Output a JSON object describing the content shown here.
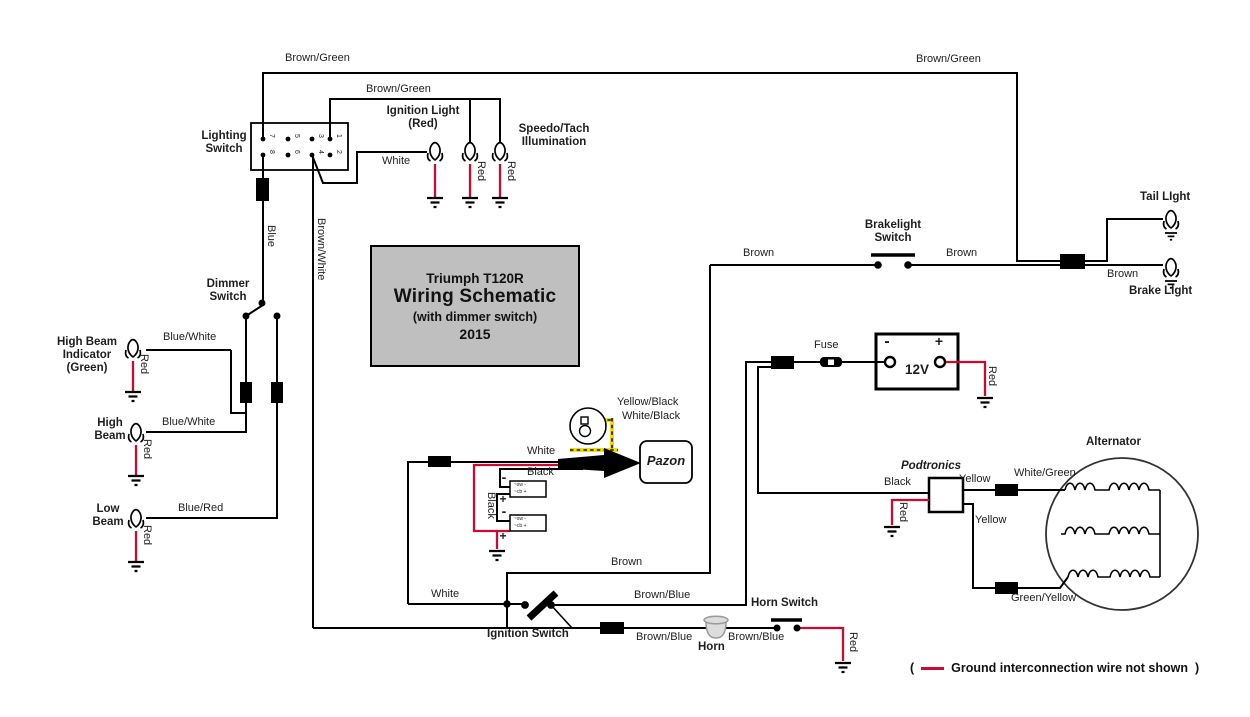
{
  "diagram": {
    "title_block": {
      "line1": "Triumph T120R",
      "line2": "Wiring Schematic",
      "line3": "(with dimmer switch)",
      "line4": "2015"
    },
    "legend": {
      "prefix": "(",
      "note": "Ground interconnection wire not shown",
      "suffix": ")"
    },
    "lighting_switch_pins": {
      "top_row": [
        "7",
        "5",
        "3",
        "1"
      ],
      "bottom_row": [
        "8",
        "6",
        "4",
        "2"
      ]
    },
    "colors": {
      "wire_black": "#000000",
      "ground_red": "#cb0a33",
      "trigger_yellow": "#f2df00",
      "title_box_bg": "#bfbfbf"
    },
    "labels": [
      {
        "name": "lighting-switch-label",
        "text": "Lighting\nSwitch",
        "x": 224,
        "y": 130,
        "s": 11.5,
        "w": "b",
        "a": "c"
      },
      {
        "name": "dimmer-switch-label",
        "text": "Dimmer\nSwitch",
        "x": 228,
        "y": 278,
        "s": 11.5,
        "w": "b",
        "a": "c"
      },
      {
        "name": "high-beam-indicator-label",
        "text": "High Beam\nIndicator\n(Green)",
        "x": 87,
        "y": 336,
        "s": 11.5,
        "w": "b",
        "a": "c"
      },
      {
        "name": "high-beam-label",
        "text": "High\nBeam",
        "x": 110,
        "y": 417,
        "s": 11.5,
        "w": "b",
        "a": "c"
      },
      {
        "name": "low-beam-label",
        "text": "Low\nBeam",
        "x": 108,
        "y": 503,
        "s": 11.5,
        "w": "b",
        "a": "c"
      },
      {
        "name": "ignition-light-label",
        "text": "Ignition Light\n(Red)",
        "x": 423,
        "y": 105,
        "s": 11.5,
        "w": "b",
        "a": "c"
      },
      {
        "name": "speedo-tach-label",
        "text": "Speedo/Tach\nIllumination",
        "x": 554,
        "y": 123,
        "s": 11.5,
        "w": "b",
        "a": "c"
      },
      {
        "name": "brakelight-switch-label",
        "text": "Brakelight\nSwitch",
        "x": 893,
        "y": 219,
        "s": 11.5,
        "w": "b",
        "a": "c"
      },
      {
        "name": "tail-light-label",
        "text": "Tail LIght",
        "x": 1140,
        "y": 191,
        "s": 11.5,
        "w": "b"
      },
      {
        "name": "brake-light-label",
        "text": "Brake LIght",
        "x": 1129,
        "y": 285,
        "s": 11.5,
        "w": "b"
      },
      {
        "name": "horn-switch-label",
        "text": "Horn Switch",
        "x": 751,
        "y": 597,
        "s": 11.5,
        "w": "b"
      },
      {
        "name": "horn-label",
        "text": "Horn",
        "x": 698,
        "y": 641,
        "s": 11.5,
        "w": "b"
      },
      {
        "name": "ignition-switch-label",
        "text": "Ignition Switch",
        "x": 487,
        "y": 628,
        "s": 11.5,
        "w": "b"
      },
      {
        "name": "alternator-label",
        "text": "Alternator",
        "x": 1086,
        "y": 436,
        "s": 11.5,
        "w": "b"
      },
      {
        "name": "podtronics-label",
        "text": "Podtronics",
        "x": 901,
        "y": 460,
        "s": 11.5,
        "w": "b",
        "i": 1
      },
      {
        "name": "pazon-label",
        "text": "Pazon",
        "x": 666,
        "y": 454,
        "s": 13,
        "w": "b",
        "i": 1,
        "a": "c"
      },
      {
        "name": "battery-voltage",
        "text": "12V",
        "x": 917,
        "y": 362,
        "s": 13.5,
        "w": "b",
        "a": "c"
      },
      {
        "name": "battery-minus",
        "text": "-",
        "x": 887,
        "y": 333,
        "s": 16,
        "w": "b",
        "a": "c"
      },
      {
        "name": "battery-plus",
        "text": "+",
        "x": 939,
        "y": 334,
        "s": 14,
        "w": "b",
        "a": "c"
      },
      {
        "name": "fuse-label",
        "text": "Fuse",
        "x": 814,
        "y": 339,
        "s": 11
      },
      {
        "name": "wire-brown-green-1",
        "text": "Brown/Green",
        "x": 285,
        "y": 52,
        "s": 11
      },
      {
        "name": "wire-brown-green-2",
        "text": "Brown/Green",
        "x": 366,
        "y": 83,
        "s": 11
      },
      {
        "name": "wire-brown-green-3",
        "text": "Brown/Green",
        "x": 916,
        "y": 53,
        "s": 11
      },
      {
        "name": "wire-white-1",
        "text": "White",
        "x": 382,
        "y": 155,
        "s": 11
      },
      {
        "name": "wire-white-2",
        "text": "White",
        "x": 527,
        "y": 445,
        "s": 11
      },
      {
        "name": "wire-white-3",
        "text": "White",
        "x": 431,
        "y": 588,
        "s": 11
      },
      {
        "name": "wire-brown-1",
        "text": "Brown",
        "x": 743,
        "y": 247,
        "s": 11
      },
      {
        "name": "wire-brown-2",
        "text": "Brown",
        "x": 946,
        "y": 247,
        "s": 11
      },
      {
        "name": "wire-brown-3",
        "text": "Brown",
        "x": 1107,
        "y": 268,
        "s": 11
      },
      {
        "name": "wire-brown-4",
        "text": "Brown",
        "x": 611,
        "y": 556,
        "s": 11
      },
      {
        "name": "wire-brown-blue-1",
        "text": "Brown/Blue",
        "x": 634,
        "y": 589,
        "s": 11
      },
      {
        "name": "wire-brown-blue-2",
        "text": "Brown/Blue",
        "x": 636,
        "y": 631,
        "s": 11
      },
      {
        "name": "wire-brown-blue-3",
        "text": "Brown/Blue",
        "x": 728,
        "y": 631,
        "s": 11
      },
      {
        "name": "wire-blue-white-1",
        "text": "Blue/White",
        "x": 163,
        "y": 331,
        "s": 11
      },
      {
        "name": "wire-blue-white-2",
        "text": "Blue/White",
        "x": 162,
        "y": 416,
        "s": 11
      },
      {
        "name": "wire-blue-red",
        "text": "Blue/Red",
        "x": 178,
        "y": 502,
        "s": 11
      },
      {
        "name": "wire-black-1",
        "text": "Black",
        "x": 527,
        "y": 466,
        "s": 11
      },
      {
        "name": "wire-black-2",
        "text": "Black",
        "x": 884,
        "y": 476,
        "s": 11
      },
      {
        "name": "wire-yellow-1",
        "text": "Yellow",
        "x": 959,
        "y": 473,
        "s": 11
      },
      {
        "name": "wire-yellow-2",
        "text": "Yellow",
        "x": 975,
        "y": 514,
        "s": 11
      },
      {
        "name": "wire-white-green",
        "text": "White/Green",
        "x": 1014,
        "y": 467,
        "s": 11
      },
      {
        "name": "wire-green-yellow",
        "text": "Green/Yellow",
        "x": 1011,
        "y": 592,
        "s": 11
      },
      {
        "name": "wire-yellow-black",
        "text": "Yellow/Black",
        "x": 617,
        "y": 396,
        "s": 11
      },
      {
        "name": "wire-white-black",
        "text": "White/Black",
        "x": 622,
        "y": 410,
        "s": 11
      },
      {
        "name": "wire-blue-rot",
        "text": "Blue",
        "x": 277,
        "y": 225,
        "s": 11,
        "r": 90
      },
      {
        "name": "wire-brown-white-rot",
        "text": "Brown/White",
        "x": 327,
        "y": 218,
        "s": 11,
        "r": 90
      },
      {
        "name": "wire-red-hbi",
        "text": "Red",
        "x": 150,
        "y": 354,
        "s": 11,
        "r": 90
      },
      {
        "name": "wire-red-high-beam",
        "text": "Red",
        "x": 153,
        "y": 439,
        "s": 11,
        "r": 90
      },
      {
        "name": "wire-red-low-beam",
        "text": "Red",
        "x": 153,
        "y": 525,
        "s": 11,
        "r": 90
      },
      {
        "name": "wire-red-ignition-bulb",
        "text": "Red",
        "x": 487,
        "y": 161,
        "s": 11,
        "r": 90
      },
      {
        "name": "wire-red-speedo-bulb",
        "text": "Red",
        "x": 517,
        "y": 161,
        "s": 11,
        "r": 90
      },
      {
        "name": "wire-red-battery",
        "text": "Red",
        "x": 998,
        "y": 366,
        "s": 11,
        "r": 90
      },
      {
        "name": "wire-red-horn",
        "text": "Red",
        "x": 859,
        "y": 632,
        "s": 11,
        "r": 90
      },
      {
        "name": "wire-red-podtronics",
        "text": "Red",
        "x": 909,
        "y": 502,
        "s": 11,
        "r": 90
      },
      {
        "name": "wire-black-coil-rot",
        "text": "Black",
        "x": 497,
        "y": 492,
        "s": 11,
        "r": 90
      },
      {
        "name": "coil1-minus",
        "text": "-",
        "x": 504,
        "y": 470,
        "s": 14,
        "w": "b",
        "a": "c"
      },
      {
        "name": "coil1-plus",
        "text": "+",
        "x": 503,
        "y": 493,
        "s": 12,
        "w": "b",
        "a": "c"
      },
      {
        "name": "coil2-minus",
        "text": "-",
        "x": 504,
        "y": 504,
        "s": 14,
        "w": "b",
        "a": "c"
      },
      {
        "name": "coil2-plus",
        "text": "+",
        "x": 503,
        "y": 530,
        "s": 12,
        "w": "b",
        "a": "c"
      },
      {
        "name": "coil1-text-top",
        "text": "~sw -",
        "x": 514,
        "y": 483,
        "s": 5
      },
      {
        "name": "coil1-text-bottom",
        "text": "~cb +",
        "x": 514,
        "y": 489.5,
        "s": 5
      },
      {
        "name": "coil2-text-top",
        "text": "~sw -",
        "x": 514,
        "y": 517,
        "s": 5
      },
      {
        "name": "coil2-text-bottom",
        "text": "~cb +",
        "x": 514,
        "y": 523.5,
        "s": 5
      }
    ]
  }
}
